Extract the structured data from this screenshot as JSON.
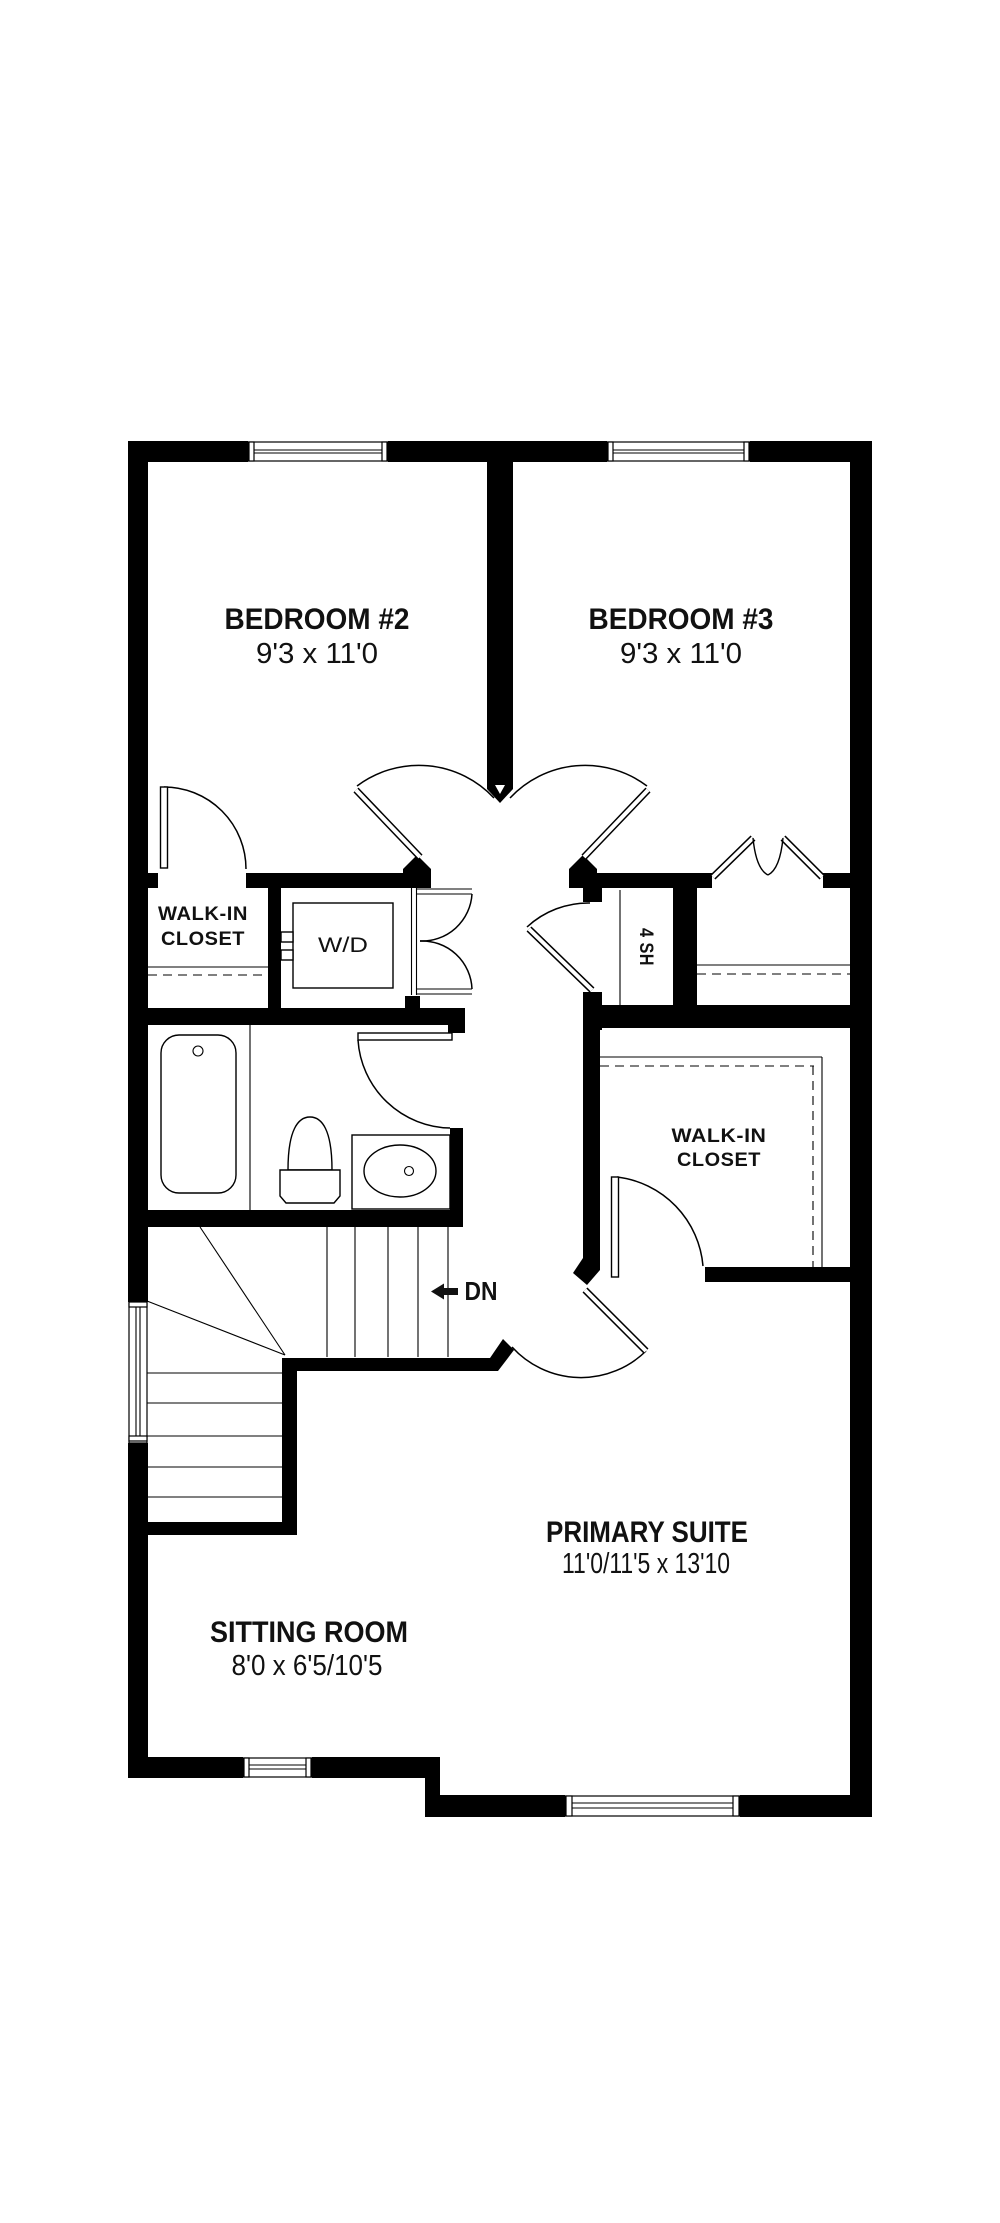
{
  "colors": {
    "wall": "#000000",
    "background": "#ffffff",
    "line": "#000000"
  },
  "rooms": {
    "bedroom2": {
      "name": "BEDROOM #2",
      "dims": "9'3 x 11'0"
    },
    "bedroom3": {
      "name": "BEDROOM #3",
      "dims": "9'3 x 11'0"
    },
    "closet_upper_left": {
      "line1": "WALK-IN",
      "line2": "CLOSET"
    },
    "closet_primary": {
      "line1": "WALK-IN",
      "line2": "CLOSET"
    },
    "primary_suite": {
      "name": "PRIMARY SUITE",
      "dims": "11'0/11'5 x 13'10"
    },
    "sitting_room": {
      "name": "SITTING ROOM",
      "dims": "8'0 x 6'5/10'5"
    }
  },
  "annotations": {
    "washer_dryer": "W/D",
    "shelves": "4 SH",
    "stairs_down": "DN"
  }
}
